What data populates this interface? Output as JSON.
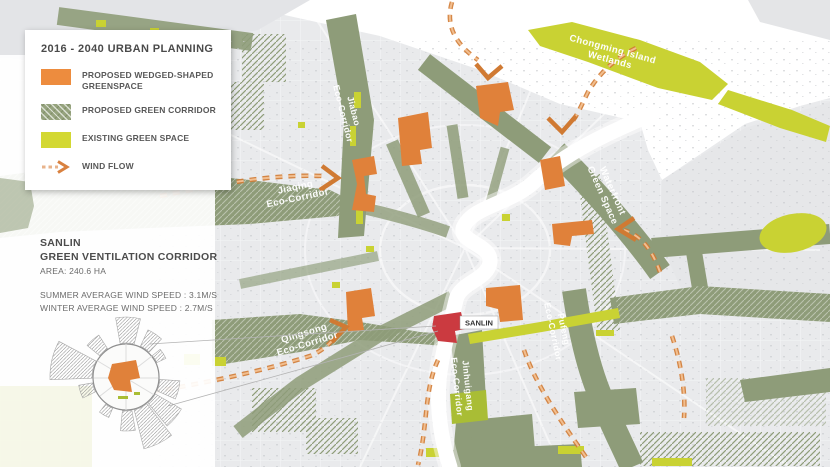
{
  "legend": {
    "title": "2016 - 2040 URBAN PLANNING",
    "items": [
      {
        "label": "PROPOSED WEDGED-SHAPED GREENSPACE",
        "swatch": "orange",
        "color": "#ED8C3E"
      },
      {
        "label": "PROPOSED GREEN CORRIDOR",
        "swatch": "green-hatch",
        "color": "#8E9C79"
      },
      {
        "label": "EXISTING GREEN SPACE",
        "swatch": "chartreuse",
        "color": "#D3D832"
      },
      {
        "label": "WIND FLOW",
        "swatch": "wind-arrow",
        "color": "#D9813F"
      }
    ]
  },
  "info": {
    "title_line1": "SANLIN",
    "title_line2": "GREEN VENTILATION CORRIDOR",
    "area": "AREA: 240.6 HA",
    "summer": "SUMMER AVERAGE WIND SPEED : 3.1M/S",
    "winter": "WINTER AVERAGE WIND SPEED : 2.7M/S"
  },
  "map_labels": {
    "jiaqing_l1": "Jiaqing",
    "jiaqing_l2": "Eco-Corridor",
    "jiabao_l1": "Jiabao",
    "jiabao_l2": "Eco-Corridor",
    "chongming_l1": "Chongming Island",
    "chongming_l2": "Wetlands",
    "waterfront_l1": "Waterfront",
    "waterfront_l2": "Green Space",
    "qingsong_l1": "Qingsong",
    "qingsong_l2": "Eco-Corridor",
    "jinhuigang_l1": "Jinhuigang",
    "jinhuigang_l2": "Eco-Corridor",
    "pufeng_l1": "Pufeng",
    "pufeng_l2": "Eco-Corridor",
    "sanlin_marker": "SANLIN"
  },
  "colors": {
    "proposed_greenspace_orange": "#E0813A",
    "green_corridor": "#8E9C79",
    "existing_green": "#C9D233",
    "wind_flow_orange": "#D9813F",
    "sanlin_red": "#CB3A40"
  },
  "wind_rose": {
    "sectors": [
      {
        "dir": 2,
        "span": 24,
        "len": 26
      },
      {
        "dir": 34,
        "span": 18,
        "len": 18
      },
      {
        "dir": 58,
        "span": 14,
        "len": 10
      },
      {
        "dir": 104,
        "span": 20,
        "len": 20
      },
      {
        "dir": 130,
        "span": 20,
        "len": 30
      },
      {
        "dir": 154,
        "span": 24,
        "len": 40
      },
      {
        "dir": 178,
        "span": 16,
        "len": 20
      },
      {
        "dir": 210,
        "span": 14,
        "len": 10
      },
      {
        "dir": 252,
        "span": 16,
        "len": 14
      },
      {
        "dir": 283,
        "span": 30,
        "len": 42
      },
      {
        "dir": 318,
        "span": 18,
        "len": 16
      }
    ]
  }
}
